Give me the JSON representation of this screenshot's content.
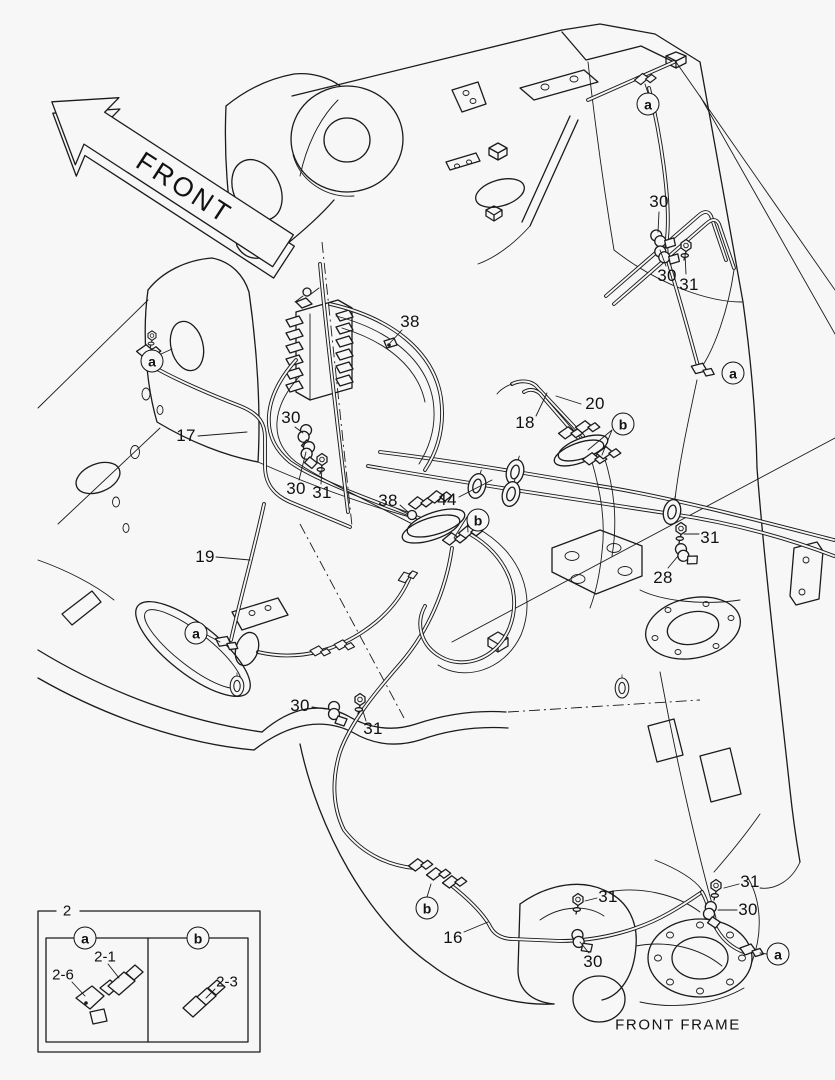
{
  "colors": {
    "background": "#f7f7f7",
    "line": "#1b1b1b",
    "text": "#111111"
  },
  "front_arrow": {
    "label": "FRONT"
  },
  "caption": "FRONT FRAME",
  "callouts": [
    {
      "id": "30-top",
      "text": "30",
      "x": 659,
      "y": 202
    },
    {
      "id": "30-top2",
      "text": "30",
      "x": 667,
      "y": 276
    },
    {
      "id": "31-top",
      "text": "31",
      "x": 689,
      "y": 285
    },
    {
      "id": "38-upper",
      "text": "38",
      "x": 410,
      "y": 322
    },
    {
      "id": "17",
      "text": "17",
      "x": 186,
      "y": 436
    },
    {
      "id": "30-midleft-1",
      "text": "30",
      "x": 291,
      "y": 418
    },
    {
      "id": "30-midleft-2",
      "text": "30",
      "x": 296,
      "y": 489
    },
    {
      "id": "31-midleft",
      "text": "31",
      "x": 322,
      "y": 493
    },
    {
      "id": "18",
      "text": "18",
      "x": 525,
      "y": 423
    },
    {
      "id": "20",
      "text": "20",
      "x": 595,
      "y": 404
    },
    {
      "id": "38-lower",
      "text": "38",
      "x": 388,
      "y": 501
    },
    {
      "id": "44",
      "text": "44",
      "x": 447,
      "y": 500
    },
    {
      "id": "31-right",
      "text": "31",
      "x": 710,
      "y": 538
    },
    {
      "id": "28",
      "text": "28",
      "x": 663,
      "y": 578
    },
    {
      "id": "19",
      "text": "19",
      "x": 205,
      "y": 557
    },
    {
      "id": "30-botmid",
      "text": "30",
      "x": 300,
      "y": 706
    },
    {
      "id": "31-botmid",
      "text": "31",
      "x": 373,
      "y": 729
    },
    {
      "id": "16",
      "text": "16",
      "x": 453,
      "y": 938
    },
    {
      "id": "31-bot",
      "text": "31",
      "x": 608,
      "y": 897
    },
    {
      "id": "30-bot",
      "text": "30",
      "x": 593,
      "y": 962
    },
    {
      "id": "31-br",
      "text": "31",
      "x": 750,
      "y": 882
    },
    {
      "id": "30-br",
      "text": "30",
      "x": 748,
      "y": 910
    }
  ],
  "circle_markers": [
    {
      "id": "a-top-right",
      "text": "a",
      "x": 648,
      "y": 104
    },
    {
      "id": "a-left",
      "text": "a",
      "x": 152,
      "y": 361
    },
    {
      "id": "a-right",
      "text": "a",
      "x": 733,
      "y": 373
    },
    {
      "id": "a-mid-left",
      "text": "a",
      "x": 196,
      "y": 633
    },
    {
      "id": "a-bottom-right",
      "text": "a",
      "x": 778,
      "y": 954
    },
    {
      "id": "b-mid-right",
      "text": "b",
      "x": 623,
      "y": 424
    },
    {
      "id": "b-mid",
      "text": "b",
      "x": 478,
      "y": 520
    },
    {
      "id": "b-bottom",
      "text": "b",
      "x": 427,
      "y": 908
    }
  ],
  "legend": {
    "group_label": "2",
    "marker_a": "a",
    "marker_b": "b",
    "part_21": "2-1",
    "part_26": "2-6",
    "part_23": "2-3"
  }
}
